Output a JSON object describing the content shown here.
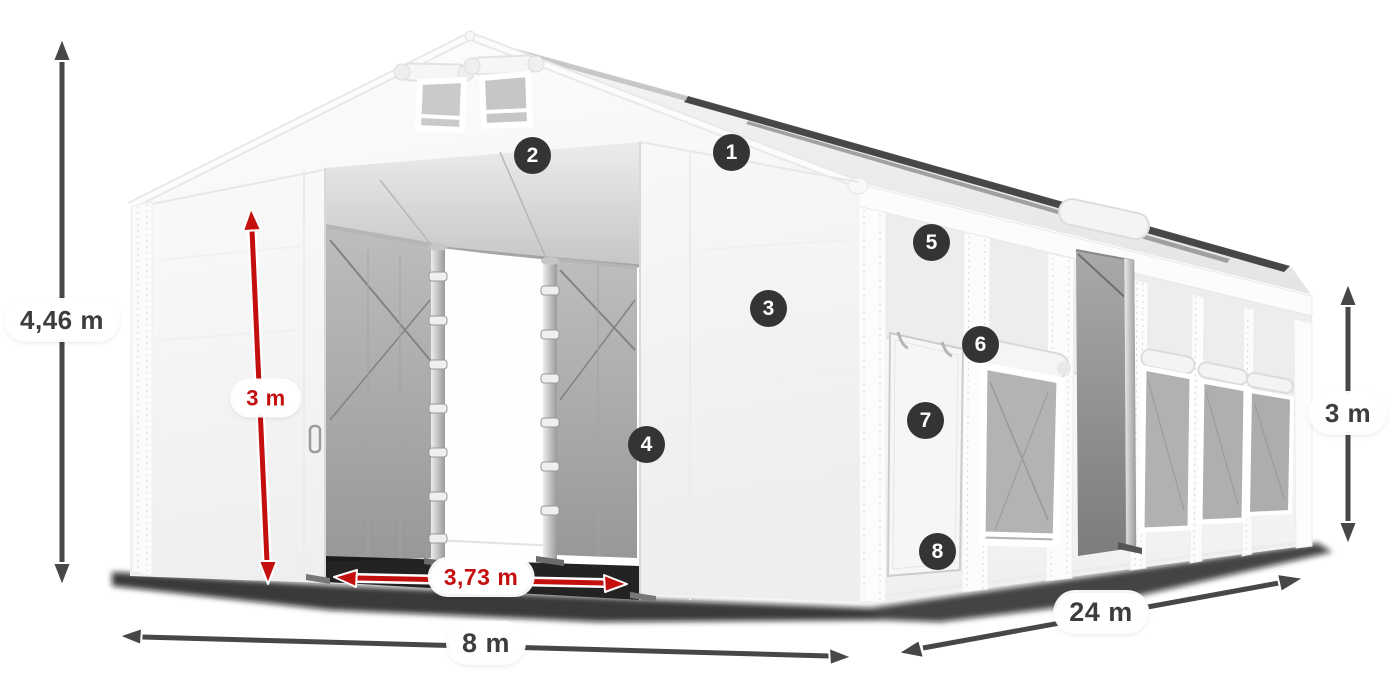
{
  "dimensions": {
    "total_height": {
      "label": "4,46 m"
    },
    "entrance_height": {
      "label": "3 m"
    },
    "entrance_width": {
      "label": "3,73 m"
    },
    "front_width": {
      "label": "8 m"
    },
    "length": {
      "label": "24 m"
    },
    "side_height": {
      "label": "3 m"
    }
  },
  "callouts": [
    {
      "number": "1"
    },
    {
      "number": "2"
    },
    {
      "number": "3"
    },
    {
      "number": "4"
    },
    {
      "number": "5"
    },
    {
      "number": "6"
    },
    {
      "number": "7"
    },
    {
      "number": "8"
    }
  ],
  "colors": {
    "background": "#ffffff",
    "tent_white": "#f7f7f7",
    "interior_gray": "#a8a8a8",
    "dimension_primary": "#474747",
    "dimension_accent_red": "#c40f0f",
    "callout_background": "#343434",
    "callout_text": "#ffffff"
  }
}
